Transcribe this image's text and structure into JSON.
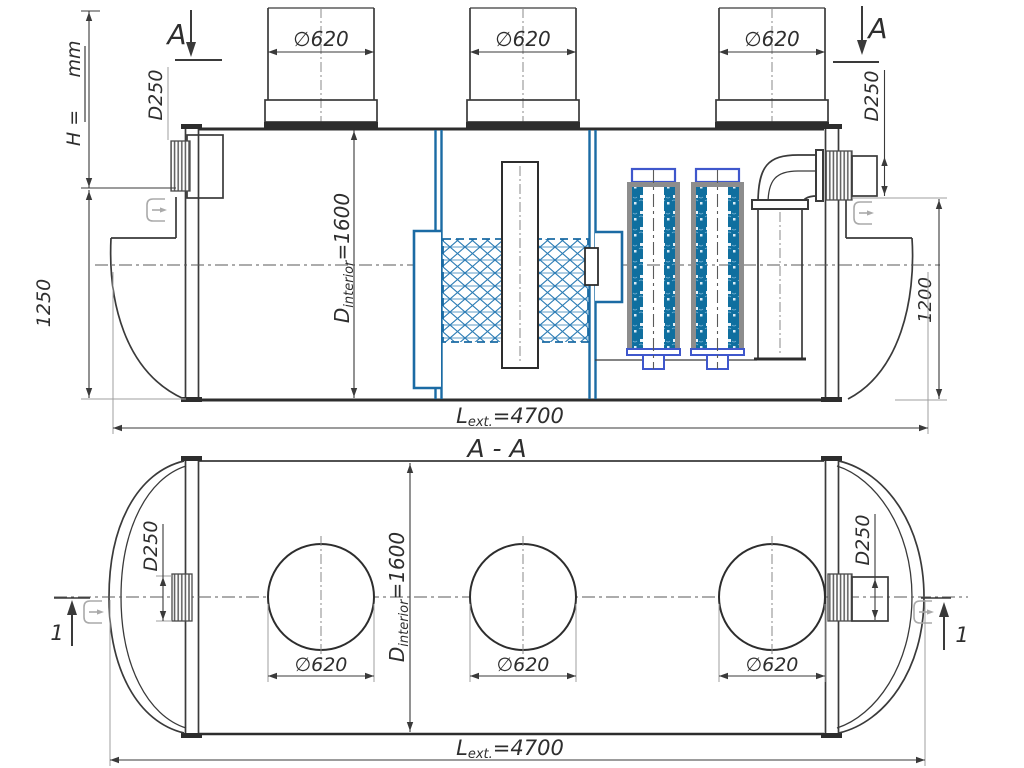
{
  "drawing": {
    "kind": "technical-drawing",
    "subject": "horizontal cylindrical separator tank, side elevation and section A-A",
    "views": {
      "side": {
        "section_marker": "A",
        "h_note": {
          "label": "H =",
          "units": "mm"
        },
        "inlet_diameter": "D250",
        "outlet_diameter": "D250",
        "inlet_invert_depth": "1250",
        "outlet_invert_depth": "1200",
        "manhole_dims": [
          "∅620",
          "∅620",
          "∅620"
        ],
        "interior_diameter": {
          "prefix": "D",
          "sub": "interior",
          "value": "=1600"
        },
        "exterior_length": {
          "prefix": "L",
          "sub": "ext.",
          "value": "=4700"
        }
      },
      "section": {
        "title": "A - A",
        "detail_marker": "1",
        "inlet_diameter": "D250",
        "outlet_diameter": "D250",
        "manhole_dims": [
          "∅620",
          "∅620",
          "∅620"
        ],
        "interior_diameter": {
          "prefix": "D",
          "sub": "interior",
          "value": "=1600"
        },
        "exterior_length": {
          "prefix": "L",
          "sub": "ext.",
          "value": "=4700"
        }
      }
    },
    "colors": {
      "line_dark": "#3a3a3a",
      "line_light": "#9f9f9f",
      "baffle_blue": "#1b6ba4",
      "hatch_blue": "#2b7cb5",
      "filter_media_blue": "#0f6f9f",
      "filter_cap_blue": "#3f57cc",
      "rail_gray": "#8d8d8d"
    }
  }
}
